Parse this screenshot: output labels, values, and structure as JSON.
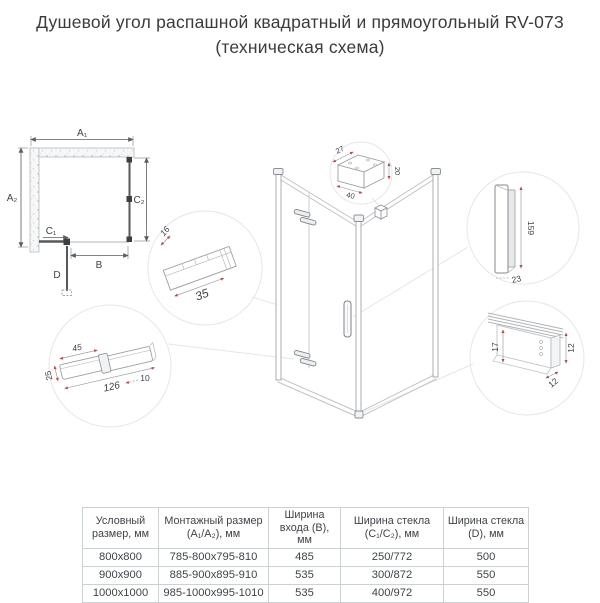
{
  "title": {
    "line1": "Душевой угол распашной квадратный и прямоугольный RV-073",
    "line2": "(техническая схема)"
  },
  "plan": {
    "dim_a1": "A₁",
    "dim_a2": "A₂",
    "dim_b": "B",
    "dim_c1": "C₁",
    "dim_c2": "C₂",
    "dim_d": "D"
  },
  "details": {
    "wall_bracket": {
      "depth": "27",
      "height": "20",
      "width": "40"
    },
    "wall_profile": {
      "depth": "16",
      "width": "35"
    },
    "handle": {
      "height": "159",
      "width": "23"
    },
    "bottom_rail": {
      "glass_height": "17",
      "height": "12",
      "depth": "12"
    },
    "hinge": {
      "plate_width": "45",
      "height": "25",
      "length": "126",
      "thickness": "10"
    }
  },
  "table": {
    "headers": [
      "Условный размер, мм",
      "Монтажный размер (A₁/A₂), мм",
      "Ширина входа (B), мм",
      "Ширина стекла (C₁/C₂), мм",
      "Ширина стекла (D), мм"
    ],
    "rows": [
      [
        "800x800",
        "785-800x795-810",
        "485",
        "250/772",
        "500"
      ],
      [
        "900x900",
        "885-900x895-910",
        "535",
        "300/872",
        "550"
      ],
      [
        "1000x1000",
        "985-1000x995-1010",
        "535",
        "400/972",
        "550"
      ]
    ]
  },
  "colors": {
    "line_light": "#c6cacd",
    "line_mid": "#9aa0a5",
    "line_dark": "#4a4e52",
    "dim_red": "#c8423a",
    "table_border": "#ccd1d5",
    "text": "#3f4449"
  }
}
